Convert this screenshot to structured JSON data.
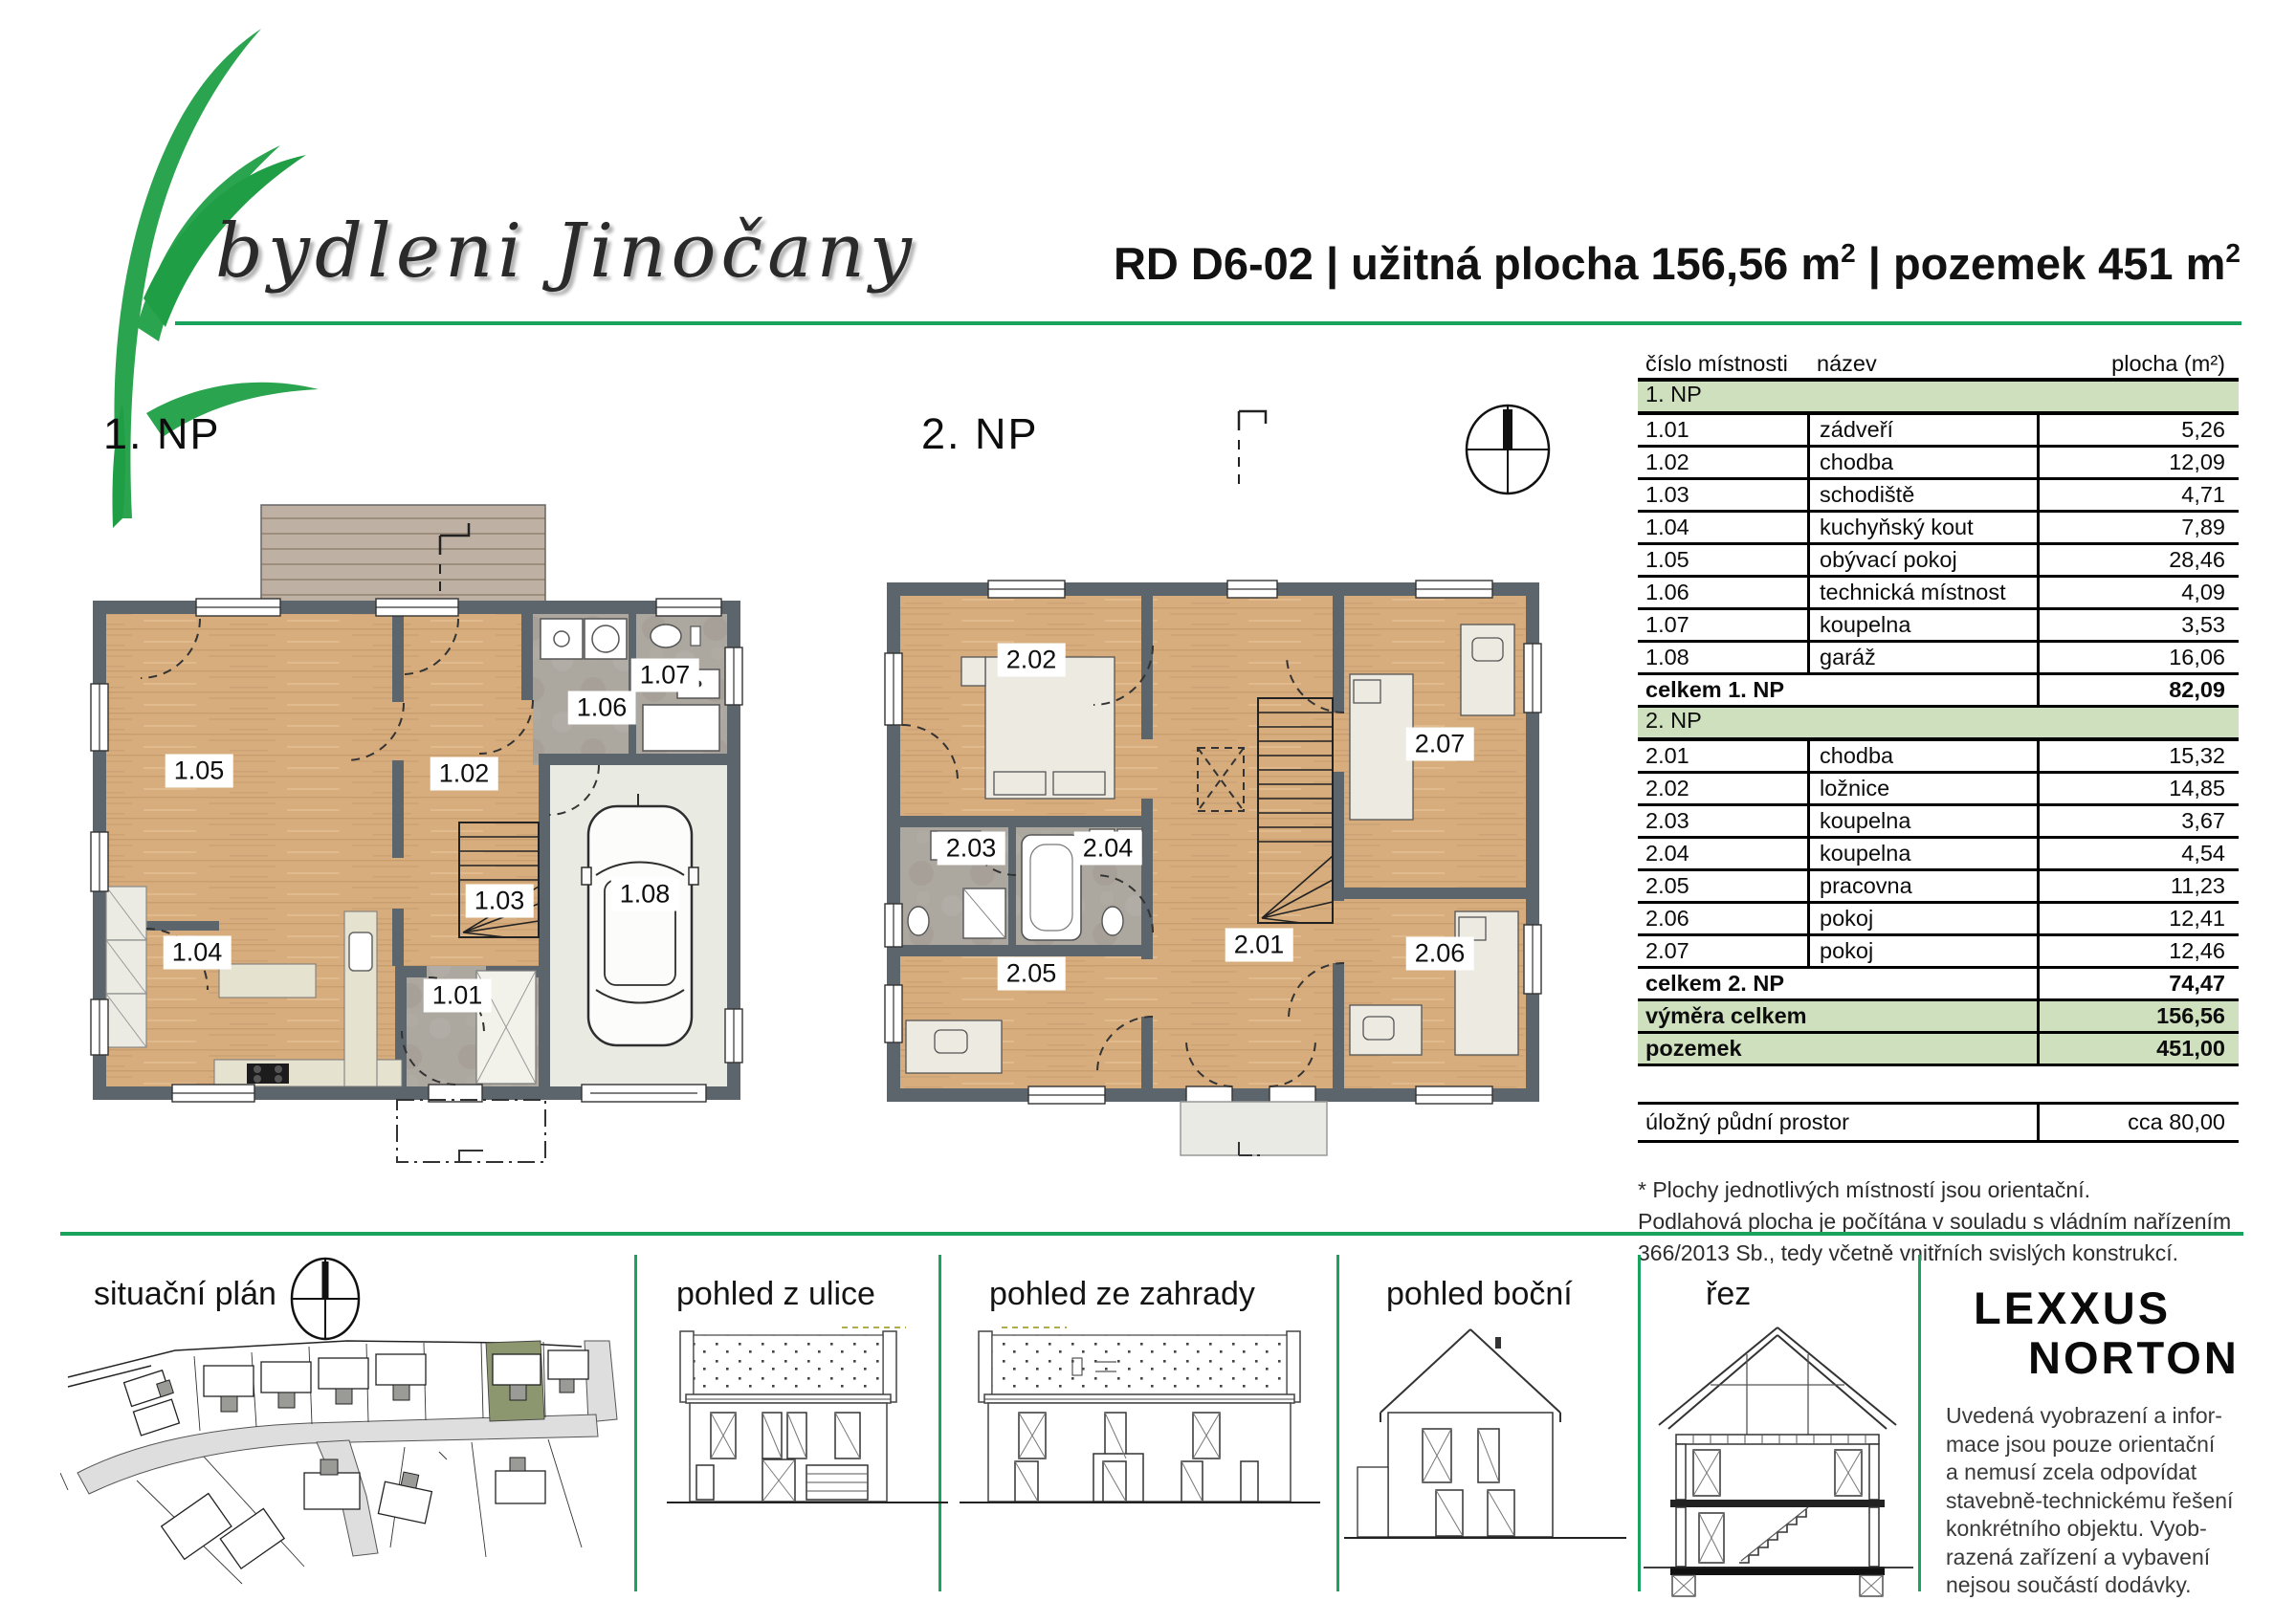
{
  "header": {
    "logo_text": "bydleni Jinočany",
    "title": {
      "part1": "RD D6-02 | užitná plocha 156,56 m",
      "sup1": "2",
      "part2": " | pozemek 451 m",
      "sup2": "2"
    }
  },
  "plans": {
    "np1": {
      "label": "1. NP",
      "rooms": [
        {
          "id": "1.01"
        },
        {
          "id": "1.02"
        },
        {
          "id": "1.03"
        },
        {
          "id": "1.04"
        },
        {
          "id": "1.05"
        },
        {
          "id": "1.06"
        },
        {
          "id": "1.07"
        },
        {
          "id": "1.08"
        }
      ]
    },
    "np2": {
      "label": "2. NP",
      "rooms": [
        {
          "id": "2.01"
        },
        {
          "id": "2.02"
        },
        {
          "id": "2.03"
        },
        {
          "id": "2.04"
        },
        {
          "id": "2.05"
        },
        {
          "id": "2.06"
        },
        {
          "id": "2.07"
        }
      ]
    }
  },
  "table": {
    "headers": {
      "col1": "číslo místnosti",
      "col2": "název",
      "col3": "plocha (m²)"
    },
    "section1": {
      "band": "1. NP",
      "rows": [
        {
          "id": "1.01",
          "name": "zádveří",
          "area": "5,26"
        },
        {
          "id": "1.02",
          "name": "chodba",
          "area": "12,09"
        },
        {
          "id": "1.03",
          "name": "schodiště",
          "area": "4,71"
        },
        {
          "id": "1.04",
          "name": "kuchyňský kout",
          "area": "7,89"
        },
        {
          "id": "1.05",
          "name": "obývací pokoj",
          "area": "28,46"
        },
        {
          "id": "1.06",
          "name": "technická místnost",
          "area": "4,09"
        },
        {
          "id": "1.07",
          "name": "koupelna",
          "area": "3,53"
        },
        {
          "id": "1.08",
          "name": "garáž",
          "area": "16,06"
        }
      ],
      "total_label": "celkem 1. NP",
      "total_value": "82,09"
    },
    "section2": {
      "band": "2. NP",
      "rows": [
        {
          "id": "2.01",
          "name": "chodba",
          "area": "15,32"
        },
        {
          "id": "2.02",
          "name": "ložnice",
          "area": "14,85"
        },
        {
          "id": "2.03",
          "name": "koupelna",
          "area": "3,67"
        },
        {
          "id": "2.04",
          "name": "koupelna",
          "area": "4,54"
        },
        {
          "id": "2.05",
          "name": "pracovna",
          "area": "11,23"
        },
        {
          "id": "2.06",
          "name": "pokoj",
          "area": "12,41"
        },
        {
          "id": "2.07",
          "name": "pokoj",
          "area": "12,46"
        }
      ],
      "total_label": "celkem 2. NP",
      "total_value": "74,47"
    },
    "summary": {
      "rows": [
        {
          "label": "výměra celkem",
          "value": "156,56"
        },
        {
          "label": "pozemek",
          "value": "451,00"
        }
      ]
    },
    "attic": {
      "label": "úložný půdní prostor",
      "value": "cca  80,00"
    }
  },
  "footnote": {
    "line1": "* Plochy jednotlivých místností jsou orientační.",
    "line2": "Podlahová plocha je počítána v souladu s vládním nařízením",
    "line3": "366/2013 Sb., tedy včetně vnitřních svislých konstrukcí."
  },
  "bottom": {
    "site_label": "situační plán",
    "street_label": "pohled z ulice",
    "garden_label": "pohled ze zahrady",
    "side_label": "pohled boční",
    "section_label": "řez",
    "brand_line1": "LEXXUS",
    "brand_line2": "NORTON",
    "disclaimer": [
      "Uvedená vyobrazení a infor-",
      "mace jsou pouze orientační",
      "a nemusí zcela odpovídat",
      "stavebně-technickému řešení",
      "konkrétního objektu. Vyob-",
      "razená zařízení a vybavení",
      "nejsou součástí dodávky."
    ]
  },
  "colors": {
    "accent_green": "#1aa35d",
    "table_band_green": "#cfe0bf",
    "wall_gray": "#5b656b",
    "wood_floor": "#d6ac7d",
    "tile_gray": "#aca79f",
    "garage_floor": "#e9ebe3",
    "terrace_wood": "#beb0a2",
    "site_highlight_olive": "#8c9770"
  }
}
